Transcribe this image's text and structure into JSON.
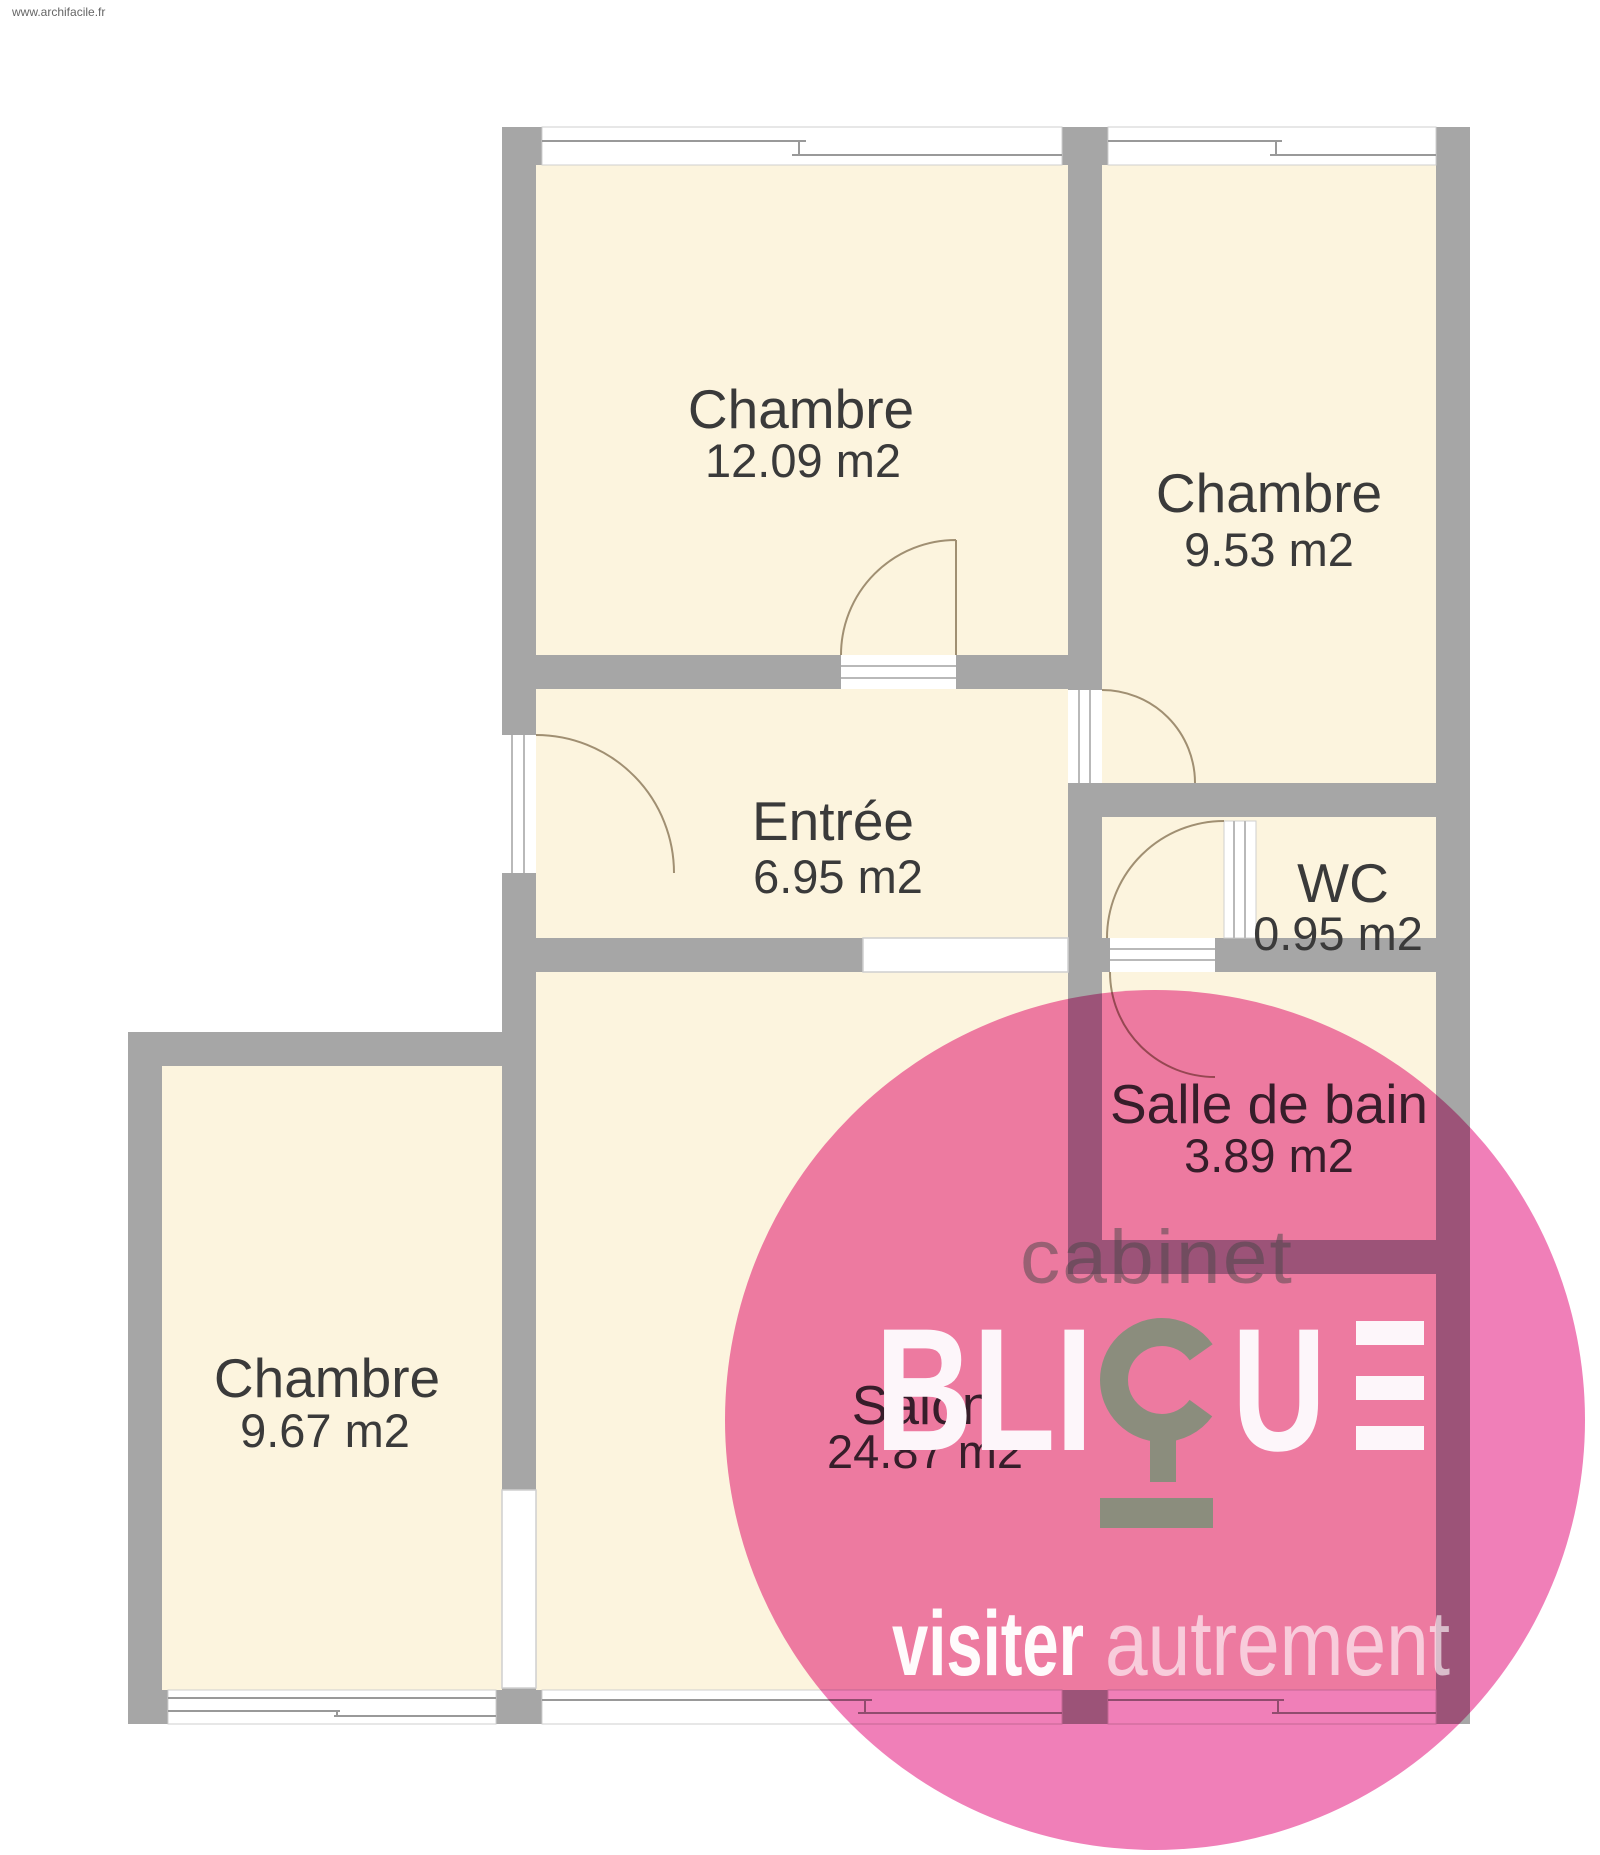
{
  "source_watermark": "www.archifacile.fr",
  "colors": {
    "wall_gray": "#a6a6a6",
    "room_fill_cream": "#fcf4de",
    "outside_white": "#ffffff",
    "window_line_gray": "#999999",
    "door_arc_brown": "#a08f72",
    "room_label_gray": "#3a3a3a",
    "watermark_pink": "#ef74b2",
    "logo_gray_green": "#8b8d7d",
    "logo_white": "#fdf6fa"
  },
  "rooms": [
    {
      "id": "chambre-1",
      "name": "Chambre",
      "area": "12.09 m2"
    },
    {
      "id": "chambre-2",
      "name": "Chambre",
      "area": "9.53 m2"
    },
    {
      "id": "entree",
      "name": "Entrée",
      "area": "6.95 m2"
    },
    {
      "id": "wc",
      "name": "WC",
      "area": "0.95 m2"
    },
    {
      "id": "salle-de-bain",
      "name": "Salle de bain",
      "area": "3.89 m2"
    },
    {
      "id": "salon",
      "name": "Salon",
      "area": "24.87 m2"
    },
    {
      "id": "chambre-3",
      "name": "Chambre",
      "area": "9.67 m2"
    }
  ],
  "watermark_logo": {
    "top_line": "cabinet",
    "brand_full": "BLIQUE",
    "brand_prefix": "BLI",
    "brand_u": "U",
    "tagline_bold": "visiter",
    "tagline_light": "autrement"
  }
}
